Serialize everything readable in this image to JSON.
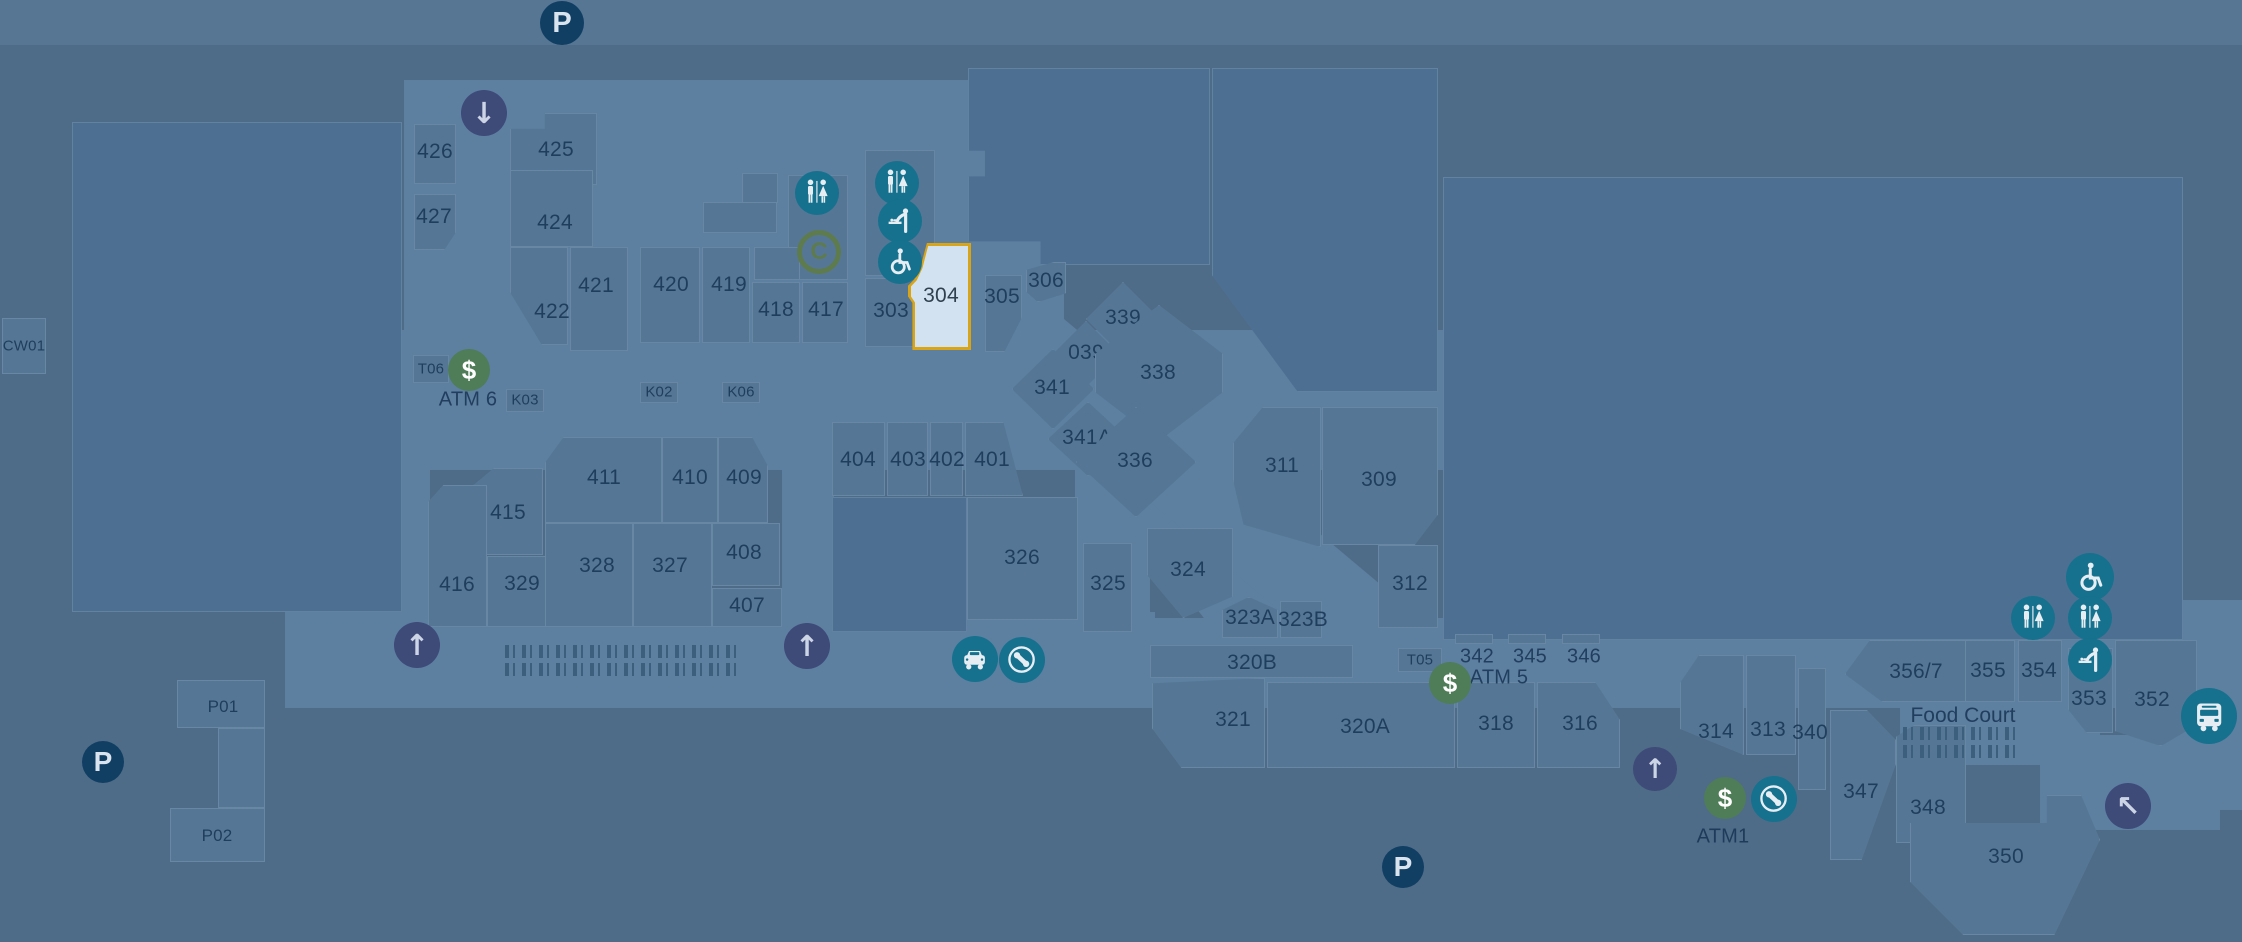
{
  "map": {
    "width": 2242,
    "height": 942
  },
  "palette": {
    "bg": "#4e6c87",
    "corridor": "#5d7fa0",
    "store": "#557795",
    "anchor": "#4d7092",
    "label": "rgba(22,50,84,0.85)",
    "highlight_fill": "#d2e2f1",
    "highlight_border": "#d9a517",
    "teal": "#15718d",
    "green": "#4e7d58",
    "navy": "#113e63",
    "indigo": "#3e4a78",
    "olive": "#5e7b4e",
    "jb_bg": "#8d9c34",
    "bigw_circle": "#1d4c7c",
    "figure": "#3d5f7e"
  },
  "selected_store": "304",
  "anchors": {
    "woolworths": {
      "name": "Woolworths",
      "code": "M201"
    },
    "bigw": {
      "name_light": "BIG",
      "name_bold": "W",
      "code": "M101"
    },
    "bestless": {
      "name": "Best&Less",
      "code": "307A"
    },
    "jbhifi": {
      "name": "JB HI-FI",
      "code": "307B"
    },
    "blooms": {
      "line1": "BLOOMS",
      "line2": "THE",
      "line3": "CHEMIST",
      "code": "406"
    },
    "foodcourt": {
      "name": "Food Court"
    }
  },
  "corridors": [
    {
      "x": 0,
      "y": 0,
      "w": 2242,
      "h": 45,
      "o": 0.5
    },
    {
      "x": 404,
      "y": 80,
      "w": 660,
      "h": 255
    },
    {
      "x": 285,
      "y": 330,
      "w": 1158,
      "h": 140
    },
    {
      "x": 285,
      "y": 330,
      "w": 145,
      "h": 300
    },
    {
      "x": 285,
      "y": 612,
      "w": 870,
      "h": 96
    },
    {
      "x": 782,
      "y": 437,
      "w": 52,
      "h": 195
    },
    {
      "x": 1155,
      "y": 618,
      "w": 1087,
      "h": 90
    },
    {
      "x": 1075,
      "y": 470,
      "w": 75,
      "h": 160
    },
    {
      "x": 1020,
      "y": 295,
      "w": 520,
      "h": 85,
      "rot": 40
    },
    {
      "x": 1148,
      "y": 452,
      "w": 300,
      "h": 72,
      "rot": 52
    },
    {
      "x": 2180,
      "y": 600,
      "w": 62,
      "h": 210
    },
    {
      "x": 2040,
      "y": 735,
      "w": 180,
      "h": 95
    },
    {
      "x": 1900,
      "y": 700,
      "w": 200,
      "h": 65
    }
  ],
  "stores": [
    {
      "id": "M201-woolworths",
      "k": "a",
      "x": 72,
      "y": 122,
      "w": 330,
      "h": 490
    },
    {
      "id": "M101-bigw",
      "k": "a",
      "x": 1443,
      "y": 177,
      "w": 740,
      "h": 463
    },
    {
      "id": "307A-bestless",
      "k": "a",
      "x": 968,
      "y": 68,
      "w": 242,
      "h": 197,
      "clip": "polygon(0 0,100% 0,100% 100%,30% 100%,30% 88%,0 88%,0 55%,7% 55%,7% 42%,0 42%)"
    },
    {
      "id": "307B-jbhifi",
      "k": "a",
      "x": 1212,
      "y": 68,
      "w": 226,
      "h": 324,
      "clip": "polygon(0 0,100% 0,100% 100%,38% 100%,0 64%)"
    },
    {
      "id": "406-blooms",
      "k": "a",
      "x": 832,
      "y": 497,
      "w": 135,
      "h": 135
    },
    {
      "id": "426",
      "x": 414,
      "y": 124,
      "w": 42,
      "h": 60,
      "lx": 435,
      "ly": 152
    },
    {
      "id": "427",
      "x": 414,
      "y": 194,
      "w": 42,
      "h": 56,
      "clip": "polygon(0 0,100% 0,100% 68%,72% 100%,0 100%)",
      "lx": 434,
      "ly": 217
    },
    {
      "id": "425",
      "x": 510,
      "y": 113,
      "w": 87,
      "h": 72,
      "clip": "polygon(0 22%,40% 22%,40% 0,100% 0,100% 100%,0 100%)",
      "lx": 556,
      "ly": 150
    },
    {
      "id": "424",
      "x": 510,
      "y": 170,
      "w": 83,
      "h": 77,
      "lx": 555,
      "ly": 223
    },
    {
      "id": "422",
      "x": 510,
      "y": 247,
      "w": 58,
      "h": 98,
      "clip": "polygon(0 0,100% 0,100% 100%,55% 100%,0 46%)",
      "lx": 552,
      "ly": 312
    },
    {
      "id": "421",
      "x": 570,
      "y": 247,
      "w": 58,
      "h": 104,
      "lx": 596,
      "ly": 286
    },
    {
      "id": "420",
      "x": 640,
      "y": 247,
      "w": 60,
      "h": 96,
      "lx": 671,
      "ly": 285
    },
    {
      "id": "419",
      "x": 702,
      "y": 247,
      "w": 48,
      "h": 96,
      "lx": 729,
      "ly": 285
    },
    {
      "id": "418",
      "x": 752,
      "y": 282,
      "w": 48,
      "h": 61,
      "lx": 776,
      "ly": 310
    },
    {
      "id": "417",
      "x": 802,
      "y": 282,
      "w": 46,
      "h": 61,
      "lx": 826,
      "ly": 310
    },
    {
      "id": "303",
      "x": 865,
      "y": 278,
      "w": 52,
      "h": 69,
      "lx": 891,
      "ly": 311
    },
    {
      "id": "305",
      "x": 985,
      "y": 275,
      "w": 37,
      "h": 77,
      "clip": "polygon(0 0,100% 0,100% 55%,52% 100%,0 100%)",
      "lx": 1002,
      "ly": 297
    },
    {
      "id": "306",
      "x": 1026,
      "y": 262,
      "w": 40,
      "h": 40,
      "clip": "polygon(0 20%,70% 0,100% 0,100% 78%,30% 100%,0 74%)",
      "lx": 1046,
      "ly": 281
    },
    {
      "id": "339",
      "x": 1086,
      "y": 282,
      "w": 74,
      "h": 74,
      "clip": "polygon(50% 0,100% 50%,50% 100%,0 50%)",
      "lx": 1123,
      "ly": 318
    },
    {
      "id": "039",
      "x": 1053,
      "y": 321,
      "w": 66,
      "h": 66,
      "clip": "polygon(50% 0,100% 50%,50% 100%,0 50%)",
      "lx": 1086,
      "ly": 353
    },
    {
      "id": "341",
      "x": 1012,
      "y": 349,
      "w": 82,
      "h": 80,
      "clip": "polygon(50% 0,100% 50%,50% 100%,0 50%)",
      "lx": 1052,
      "ly": 388
    },
    {
      "id": "338",
      "x": 1095,
      "y": 305,
      "w": 128,
      "h": 136,
      "clip": "polygon(50% 0,100% 36%,100% 64%,50% 100%,0 64%,0 36%)",
      "lx": 1158,
      "ly": 373
    },
    {
      "id": "341A",
      "x": 1048,
      "y": 402,
      "w": 80,
      "h": 74,
      "clip": "polygon(50% 0,100% 50%,50% 100%,0 50%)",
      "lx": 1087,
      "ly": 438
    },
    {
      "id": "336",
      "x": 1076,
      "y": 407,
      "w": 120,
      "h": 110,
      "clip": "polygon(50% 0,100% 50%,50% 100%,0 50%)",
      "lx": 1135,
      "ly": 461
    },
    {
      "id": "311",
      "x": 1233,
      "y": 407,
      "w": 88,
      "h": 140,
      "clip": "polygon(34% 0,100% 0,100% 100%,12% 84%,0 52%,0 26%)",
      "lx": 1282,
      "ly": 466
    },
    {
      "id": "309",
      "x": 1322,
      "y": 407,
      "w": 116,
      "h": 138,
      "clip": "polygon(0 0,100% 0,100% 78%,80% 100%,0 100%)",
      "lx": 1379,
      "ly": 480
    },
    {
      "id": "312",
      "x": 1378,
      "y": 545,
      "w": 60,
      "h": 83,
      "lx": 1410,
      "ly": 584
    },
    {
      "id": "324",
      "x": 1147,
      "y": 528,
      "w": 86,
      "h": 90,
      "clip": "polygon(0 0,100% 0,100% 76%,42% 100%,0 52%)",
      "lx": 1188,
      "ly": 570
    },
    {
      "id": "323A",
      "x": 1222,
      "y": 597,
      "w": 56,
      "h": 41,
      "clip": "polygon(0 32%,48% 0,100% 32%,100% 100%,0 100%)",
      "lx": 1250,
      "ly": 618
    },
    {
      "id": "323B",
      "x": 1280,
      "y": 601,
      "w": 42,
      "h": 37,
      "lx": 1303,
      "ly": 620
    },
    {
      "id": "320B",
      "x": 1150,
      "y": 645,
      "w": 203,
      "h": 33,
      "lx": 1252,
      "ly": 663
    },
    {
      "id": "321",
      "x": 1152,
      "y": 678,
      "w": 113,
      "h": 90,
      "clip": "polygon(0 6%,100% 0,100% 100%,26% 100%,0 56%)",
      "lx": 1233,
      "ly": 720
    },
    {
      "id": "320A",
      "x": 1267,
      "y": 682,
      "w": 188,
      "h": 86,
      "lx": 1365,
      "ly": 727
    },
    {
      "id": "318",
      "x": 1457,
      "y": 682,
      "w": 78,
      "h": 86,
      "lx": 1496,
      "ly": 724
    },
    {
      "id": "316",
      "x": 1537,
      "y": 682,
      "w": 83,
      "h": 86,
      "clip": "polygon(0 0,70% 0,100% 44%,100% 100%,0 100%)",
      "lx": 1580,
      "ly": 724
    },
    {
      "id": "326",
      "x": 967,
      "y": 497,
      "w": 111,
      "h": 123,
      "lx": 1022,
      "ly": 558
    },
    {
      "id": "325",
      "x": 1083,
      "y": 543,
      "w": 49,
      "h": 89,
      "lx": 1108,
      "ly": 584
    },
    {
      "id": "404",
      "x": 832,
      "y": 422,
      "w": 53,
      "h": 74,
      "lx": 858,
      "ly": 460
    },
    {
      "id": "403",
      "x": 887,
      "y": 422,
      "w": 41,
      "h": 74,
      "lx": 908,
      "ly": 460
    },
    {
      "id": "402",
      "x": 930,
      "y": 422,
      "w": 33,
      "h": 74,
      "lx": 947,
      "ly": 460
    },
    {
      "id": "401",
      "x": 965,
      "y": 422,
      "w": 58,
      "h": 74,
      "clip": "polygon(0 0,66% 0,100% 100%,0 100%)",
      "lx": 992,
      "ly": 460
    },
    {
      "id": "411",
      "x": 545,
      "y": 437,
      "w": 117,
      "h": 86,
      "clip": "polygon(16% 0,100% 0,100% 100%,0 100%,0 30%)",
      "lx": 604,
      "ly": 478
    },
    {
      "id": "410",
      "x": 662,
      "y": 437,
      "w": 56,
      "h": 86,
      "lx": 690,
      "ly": 478
    },
    {
      "id": "409",
      "x": 718,
      "y": 437,
      "w": 50,
      "h": 86,
      "clip": "polygon(0 0,68% 0,100% 34%,100% 100%,0 100%)",
      "lx": 744,
      "ly": 478
    },
    {
      "id": "415",
      "x": 473,
      "y": 468,
      "w": 70,
      "h": 87,
      "clip": "polygon(0 20%,30% 0,100% 0,100% 100%,0 100%)",
      "lx": 508,
      "ly": 513
    },
    {
      "id": "416",
      "x": 428,
      "y": 485,
      "w": 59,
      "h": 142,
      "clip": "polygon(0 12%,26% 0,100% 0,100% 100%,0 100%)",
      "lx": 457,
      "ly": 585
    },
    {
      "id": "329",
      "x": 487,
      "y": 556,
      "w": 75,
      "h": 71,
      "lx": 522,
      "ly": 584
    },
    {
      "id": "328",
      "x": 545,
      "y": 523,
      "w": 88,
      "h": 104,
      "lx": 597,
      "ly": 566
    },
    {
      "id": "327",
      "x": 633,
      "y": 523,
      "w": 79,
      "h": 104,
      "lx": 670,
      "ly": 566
    },
    {
      "id": "408",
      "x": 712,
      "y": 523,
      "w": 68,
      "h": 63,
      "lx": 744,
      "ly": 553
    },
    {
      "id": "407",
      "x": 712,
      "y": 588,
      "w": 70,
      "h": 39,
      "lx": 747,
      "ly": 606
    },
    {
      "id": "356/7",
      "x": 1845,
      "y": 640,
      "w": 125,
      "h": 62,
      "clip": "polygon(20% 0,100% 0,100% 100%,30% 100%,0 55%)",
      "lx": 1916,
      "ly": 672
    },
    {
      "id": "355",
      "x": 1965,
      "y": 640,
      "w": 50,
      "h": 62,
      "lx": 1988,
      "ly": 671
    },
    {
      "id": "354",
      "x": 2018,
      "y": 640,
      "w": 44,
      "h": 62,
      "lx": 2039,
      "ly": 671
    },
    {
      "id": "353",
      "x": 2068,
      "y": 648,
      "w": 45,
      "h": 85,
      "clip": "polygon(0 0,100% 0,100% 100%,42% 100%,0 72%)",
      "lx": 2089,
      "ly": 699
    },
    {
      "id": "352",
      "x": 2115,
      "y": 640,
      "w": 82,
      "h": 106,
      "clip": "polygon(0 0,100% 0,100% 80%,56% 100%,0 86%)",
      "lx": 2152,
      "ly": 700
    },
    {
      "id": "314",
      "x": 1680,
      "y": 655,
      "w": 64,
      "h": 100,
      "clip": "polygon(30% 0,100% 0,100% 100%,0 74%,0 28%)",
      "lx": 1716,
      "ly": 732
    },
    {
      "id": "313",
      "x": 1746,
      "y": 655,
      "w": 50,
      "h": 100,
      "lx": 1768,
      "ly": 730
    },
    {
      "id": "340",
      "x": 1798,
      "y": 668,
      "w": 28,
      "h": 122,
      "lx": 1810,
      "ly": 733
    },
    {
      "id": "347",
      "x": 1830,
      "y": 710,
      "w": 66,
      "h": 150,
      "clip": "polygon(0 0,56% 0,100% 20%,100% 36%,48% 100%,0 100%)",
      "lx": 1861,
      "ly": 792
    },
    {
      "id": "348",
      "x": 1896,
      "y": 725,
      "w": 70,
      "h": 118,
      "clip": "polygon(0 10%,26% 0,100% 0,100% 100%,62% 100%,50% 85%,38% 100%,0 100%)",
      "lx": 1928,
      "ly": 808
    },
    {
      "id": "350",
      "x": 1910,
      "y": 795,
      "w": 190,
      "h": 140,
      "clip": "polygon(0 20%,72% 20%,72% 0,90% 0,100% 32%,76% 100%,28% 100%,0 62%)",
      "lx": 2006,
      "ly": 857
    },
    {
      "id": "CW01",
      "k": "k",
      "x": 2,
      "y": 318,
      "w": 44,
      "h": 56,
      "lx": 24,
      "ly": 346,
      "fs": 15
    },
    {
      "id": "T06",
      "k": "k",
      "x": 413,
      "y": 355,
      "w": 36,
      "h": 28,
      "lx": 431,
      "ly": 369,
      "fs": 15
    },
    {
      "id": "K03",
      "k": "k",
      "x": 506,
      "y": 389,
      "w": 38,
      "h": 23,
      "lx": 525,
      "ly": 400,
      "fs": 15
    },
    {
      "id": "K02",
      "k": "k",
      "x": 640,
      "y": 382,
      "w": 38,
      "h": 21,
      "lx": 659,
      "ly": 392,
      "fs": 15
    },
    {
      "id": "K06",
      "k": "k",
      "x": 722,
      "y": 382,
      "w": 38,
      "h": 21,
      "lx": 741,
      "ly": 392,
      "fs": 15
    },
    {
      "id": "T05",
      "k": "k",
      "x": 1398,
      "y": 648,
      "w": 44,
      "h": 24,
      "lx": 1420,
      "ly": 660,
      "fs": 15
    },
    {
      "id": "P01",
      "k": "f",
      "x": 177,
      "y": 680,
      "w": 88,
      "h": 48,
      "lx": 223,
      "ly": 707,
      "fs": 17
    },
    {
      "id": "P-link",
      "k": "f",
      "x": 218,
      "y": 728,
      "w": 47,
      "h": 80
    },
    {
      "id": "P02",
      "k": "f",
      "x": 170,
      "y": 808,
      "w": 95,
      "h": 54,
      "lx": 217,
      "ly": 836,
      "fs": 17
    },
    {
      "id": "block-amenity-left",
      "k": "f",
      "x": 788,
      "y": 175,
      "w": 60,
      "h": 105
    },
    {
      "id": "block-amenity-303",
      "k": "f",
      "x": 865,
      "y": 150,
      "w": 70,
      "h": 126
    },
    {
      "id": "block-419a",
      "k": "f",
      "x": 742,
      "y": 173,
      "w": 36,
      "h": 30
    },
    {
      "id": "block-419b",
      "k": "f",
      "x": 703,
      "y": 202,
      "w": 74,
      "h": 31
    },
    {
      "id": "block-418top",
      "k": "f",
      "x": 754,
      "y": 247,
      "w": 46,
      "h": 33
    },
    {
      "id": "tab-342",
      "k": "f",
      "x": 1455,
      "y": 634,
      "w": 38,
      "h": 10
    },
    {
      "id": "tab-345",
      "k": "f",
      "x": 1508,
      "y": 634,
      "w": 38,
      "h": 10
    },
    {
      "id": "tab-346",
      "k": "f",
      "x": 1562,
      "y": 634,
      "w": 38,
      "h": 10
    }
  ],
  "highlighted": {
    "id": "304",
    "x": 908,
    "y": 243,
    "w": 63,
    "h": 107,
    "clip": "polygon(30% 0,100% 0,100% 100%,7% 100%,7% 56%,0 50%,0 40%,10% 34%,20% 22%)",
    "lx": 941,
    "ly": 296
  },
  "free_labels": [
    {
      "t": "342",
      "x": 1477,
      "y": 657
    },
    {
      "t": "345",
      "x": 1530,
      "y": 657
    },
    {
      "t": "346",
      "x": 1584,
      "y": 657
    },
    {
      "t": "ATM 6",
      "x": 468,
      "y": 400
    },
    {
      "t": "ATM 5",
      "x": 1499,
      "y": 678
    },
    {
      "t": "ATM1",
      "x": 1723,
      "y": 837
    }
  ],
  "icons": [
    {
      "t": "parking",
      "x": 562,
      "y": 23,
      "d": 44
    },
    {
      "t": "parking",
      "x": 103,
      "y": 762,
      "d": 42
    },
    {
      "t": "parking",
      "x": 1403,
      "y": 867,
      "d": 42
    },
    {
      "t": "escalator-down",
      "x": 484,
      "y": 113,
      "d": 46
    },
    {
      "t": "escalator-up",
      "x": 417,
      "y": 645,
      "d": 46
    },
    {
      "t": "escalator-up",
      "x": 807,
      "y": 646,
      "d": 46
    },
    {
      "t": "escalator-up",
      "x": 1655,
      "y": 769,
      "d": 44
    },
    {
      "t": "escalator-up-left",
      "x": 2128,
      "y": 806,
      "d": 46
    },
    {
      "t": "atm",
      "x": 469,
      "y": 370,
      "d": 42
    },
    {
      "t": "atm",
      "x": 1450,
      "y": 683,
      "d": 42
    },
    {
      "t": "atm",
      "x": 1725,
      "y": 798,
      "d": 42
    },
    {
      "t": "toilets",
      "x": 817,
      "y": 193,
      "d": 44
    },
    {
      "t": "toilets",
      "x": 897,
      "y": 183,
      "d": 44
    },
    {
      "t": "baby-change",
      "x": 900,
      "y": 221,
      "d": 44
    },
    {
      "t": "wheelchair",
      "x": 900,
      "y": 262,
      "d": 44
    },
    {
      "t": "wheelchair",
      "x": 2090,
      "y": 577,
      "d": 48
    },
    {
      "t": "toilets",
      "x": 2033,
      "y": 618,
      "d": 44
    },
    {
      "t": "toilets",
      "x": 2090,
      "y": 618,
      "d": 44
    },
    {
      "t": "baby-change",
      "x": 2090,
      "y": 660,
      "d": 44
    },
    {
      "t": "taxi",
      "x": 975,
      "y": 659,
      "d": 46
    },
    {
      "t": "phone",
      "x": 1022,
      "y": 660,
      "d": 46
    },
    {
      "t": "phone",
      "x": 1774,
      "y": 799,
      "d": 46
    },
    {
      "t": "bus",
      "x": 2209,
      "y": 716,
      "d": 56
    },
    {
      "t": "concierge-c",
      "x": 819,
      "y": 252,
      "d": 44
    }
  ],
  "people_rows": [
    {
      "x": 505,
      "y": 645,
      "w": 235
    },
    {
      "x": 505,
      "y": 663,
      "w": 235
    },
    {
      "x": 1903,
      "y": 727,
      "w": 116
    },
    {
      "x": 1903,
      "y": 745,
      "w": 116
    }
  ]
}
